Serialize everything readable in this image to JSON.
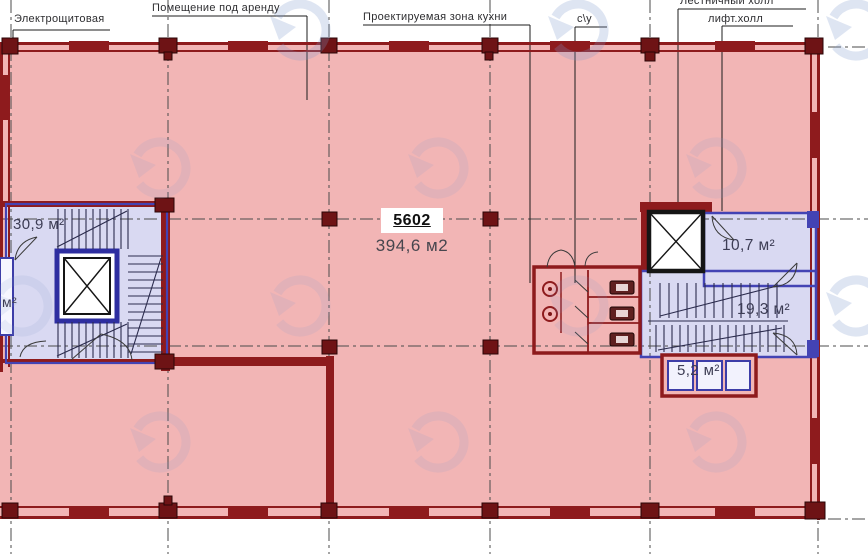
{
  "colors": {
    "plan-pink": "#f2b5b5",
    "wall-red": "#8e1b1d",
    "wall-red-dark": "#6e1315",
    "room-lavender": "#d9d9f2",
    "wall-blue": "#4343b4",
    "grid-gray": "#4b4b4b",
    "leader-black": "#1c1c1c",
    "watermark-blue": "#8099cc",
    "label-dark": "#2e2e31",
    "area-label": "#3d3d55"
  },
  "plan": {
    "top_labels": {
      "electrical_room": "Электрощитовая",
      "rental_space": "Помещение под аренду",
      "kitchen_zone": "Проектируемая зона кухни",
      "wc": "с\\у",
      "stair_hall": "Лестничный холл",
      "lift_hall": "лифт.холл"
    },
    "unit": {
      "number": "5602",
      "area": "394,6 м2"
    },
    "rooms": {
      "stair_block_left": "30,9 м²",
      "left_edge_partial": "м²",
      "lift_lobby": "10,7 м²",
      "stair_block_right": "19,3 м²",
      "shaft_box": "5,2 м²"
    }
  }
}
